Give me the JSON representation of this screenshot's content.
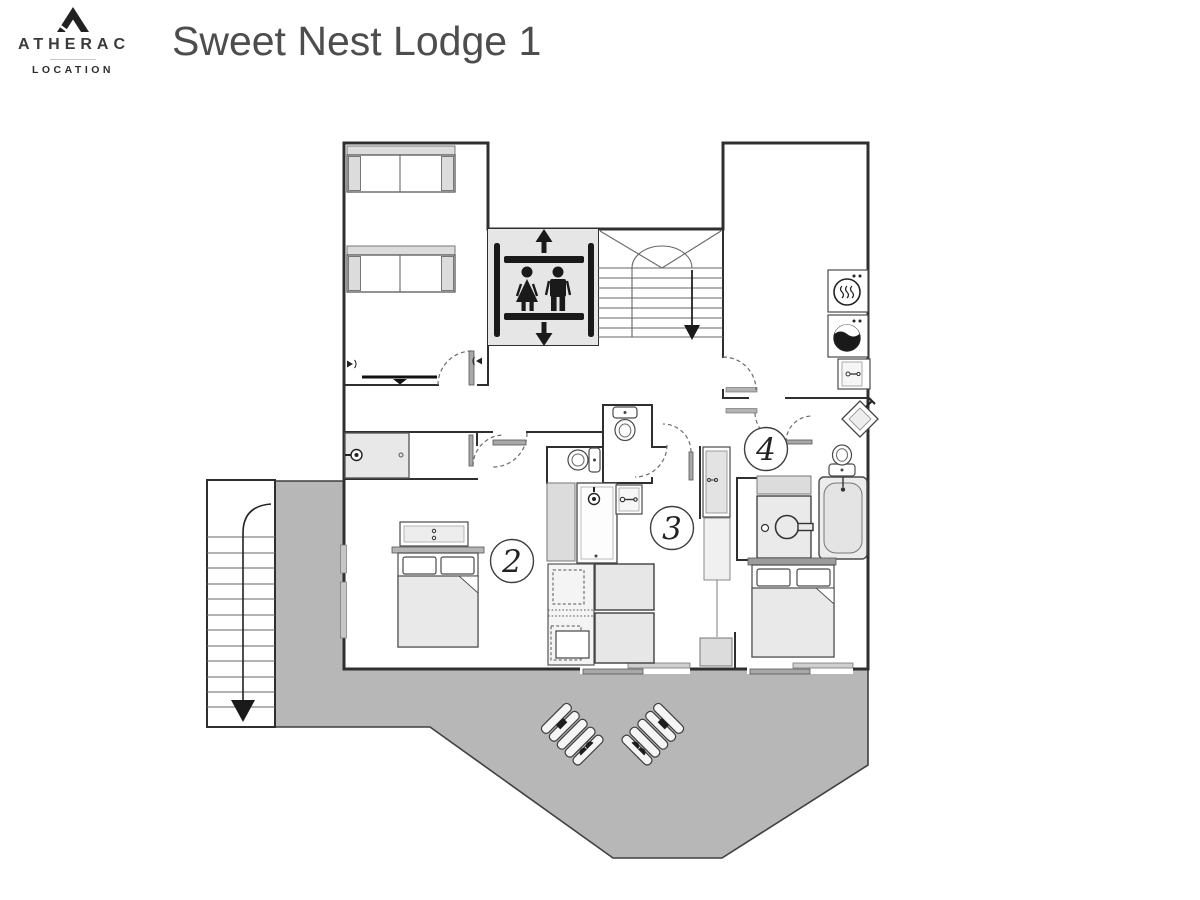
{
  "header": {
    "brand": "ATHERAC",
    "brand_subtitle": "LOCATION",
    "title": "Sweet Nest Lodge 1"
  },
  "plan": {
    "room_labels": {
      "room2": "2",
      "room3": "3",
      "room4": "4"
    },
    "colors": {
      "wall": "#2f2f2f",
      "pictogram": "#1a1a1a",
      "furniture_fill": "#e9e9e9",
      "fixture_gray": "#dcdcdc",
      "door_leaf": "#a8a8a8",
      "terrace": "#b7b7b7",
      "elevator_bg": "#e6e6e6",
      "title_text": "#4d4d4d",
      "brand_text": "#3a3a3a"
    },
    "icons": [
      "mountain-logo-icon",
      "elevator-icon",
      "woman-icon",
      "man-icon",
      "up-arrow-icon",
      "down-arrow-icon",
      "interior-stairs-icon",
      "exterior-stairs-icon",
      "dryer-icon",
      "washing-machine-icon",
      "cabinet-icon",
      "toilet-icon",
      "shower-head-icon",
      "shower-mixer-icon",
      "bathtub-icon",
      "sink-icon",
      "diamond-sink-icon",
      "tv-icon",
      "speaker-icon",
      "sofa-bed-icon",
      "double-bed-icon",
      "bunk-bed-icon",
      "wardrobe-icon",
      "lounge-chair-icon",
      "window-icon",
      "sliding-door-icon",
      "door-arc-icon"
    ]
  }
}
